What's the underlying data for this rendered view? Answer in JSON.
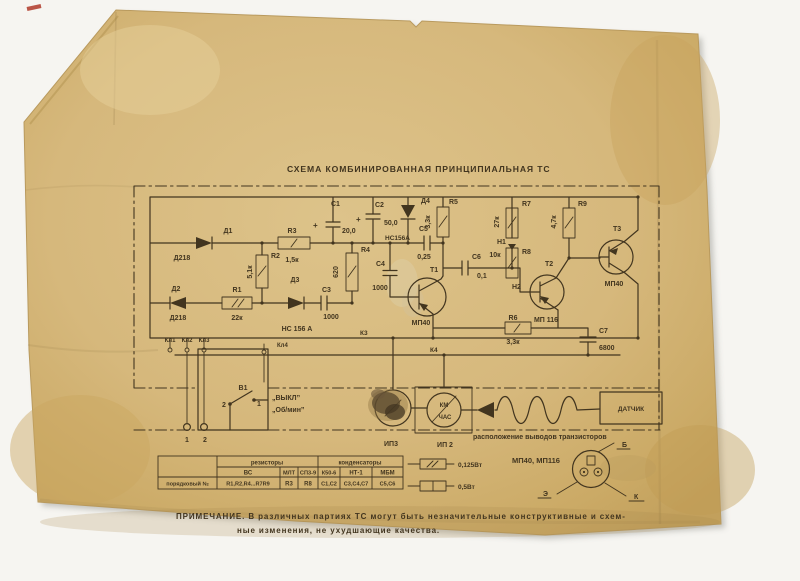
{
  "title": "СХЕМА КОМБИНИРОВАННАЯ ПРИНЦИПИАЛЬНАЯ ТС",
  "misc": {
    "plus": "+"
  },
  "components": {
    "c1": {
      "ref": "С1",
      "value": "20,0"
    },
    "c2": {
      "ref": "С2",
      "value": "50,0"
    },
    "c3": {
      "ref": "С3",
      "value": "1000"
    },
    "c4": {
      "ref": "С4",
      "value": "1000"
    },
    "c5": {
      "ref": "С5",
      "value": "0,25"
    },
    "c6": {
      "ref": "С6",
      "value": "0,1"
    },
    "c7": {
      "ref": "С7",
      "value": "6800"
    },
    "r1": {
      "ref": "R1",
      "value": "22к"
    },
    "r2": {
      "ref": "R2",
      "value": "5,1к"
    },
    "r3": {
      "ref": "R3",
      "value": "1,5к"
    },
    "r4": {
      "ref": "R4",
      "value": "620"
    },
    "r5": {
      "ref": "R5",
      "value": "3,3к"
    },
    "r6": {
      "ref": "R6",
      "value": "3,3к"
    },
    "r7": {
      "ref": "R7",
      "value": "27к"
    },
    "r8": {
      "ref": "R8",
      "value": "10к"
    },
    "r9": {
      "ref": "R9",
      "value": "4,7к"
    },
    "d1": {
      "ref": "Д1",
      "type": "Д218"
    },
    "d2": {
      "ref": "Д2",
      "type": "Д218"
    },
    "d3": {
      "ref": "Д3",
      "type": "НС 156 А"
    },
    "d4": {
      "ref": "Д4",
      "type": "НС156А"
    },
    "t1": {
      "ref": "Т1",
      "type": "МП40"
    },
    "t2": {
      "ref": "Т2",
      "type": "МП 116"
    },
    "t3": {
      "ref": "Т3",
      "type": "МП40"
    },
    "h1": "Н1",
    "h2": "Н2"
  },
  "nodes": {
    "k3": "К3",
    "k4": "К4",
    "kl1": "Кл1",
    "kl2": "Кл2",
    "kl3": "Кл3",
    "kl4": "Кл4",
    "term1": "1",
    "term2": "2"
  },
  "switch": {
    "ref": "В1",
    "pos1": "1",
    "pos2": "2",
    "label_off": "„ВЫКЛ”",
    "label_mode": "„Об/мин”"
  },
  "meters": {
    "ip3": "ИП3",
    "ip2": "ИП 2",
    "scale_top": "КМ",
    "scale_bottom": "ЧАС"
  },
  "sensor": {
    "label": "ДАТЧИК"
  },
  "pinout": {
    "caption": "расположение выводов транзисторов",
    "types": "МП40, МП116",
    "b": "Б",
    "e": "Э",
    "k": "К"
  },
  "legend": {
    "power_small": "0,125Вт",
    "power_big": "0,5Вт"
  },
  "table": {
    "row_header": "порядковый №",
    "groups": [
      "резисторы",
      "конденсаторы"
    ],
    "types": [
      "ВС",
      "МЛТ",
      "СП3-9",
      "К50-6",
      "НТ-1",
      "МБМ"
    ],
    "values": [
      "R1,R2,R4...R7R9",
      "R3",
      "R8",
      "С1,С2",
      "С3,С4,С7",
      "С5,С6"
    ]
  },
  "note": {
    "line1": "ПРИМЕЧАНИЕ. В различных партиях ТС могут быть незначительные конструктивные и схем-",
    "line2": "ные изменения, не ухудшающие качества."
  },
  "colors": {
    "paper": "#d8ba7e",
    "ink": "#42351f",
    "background": "#f6f5f1",
    "red_mark": "#b03a2a"
  }
}
